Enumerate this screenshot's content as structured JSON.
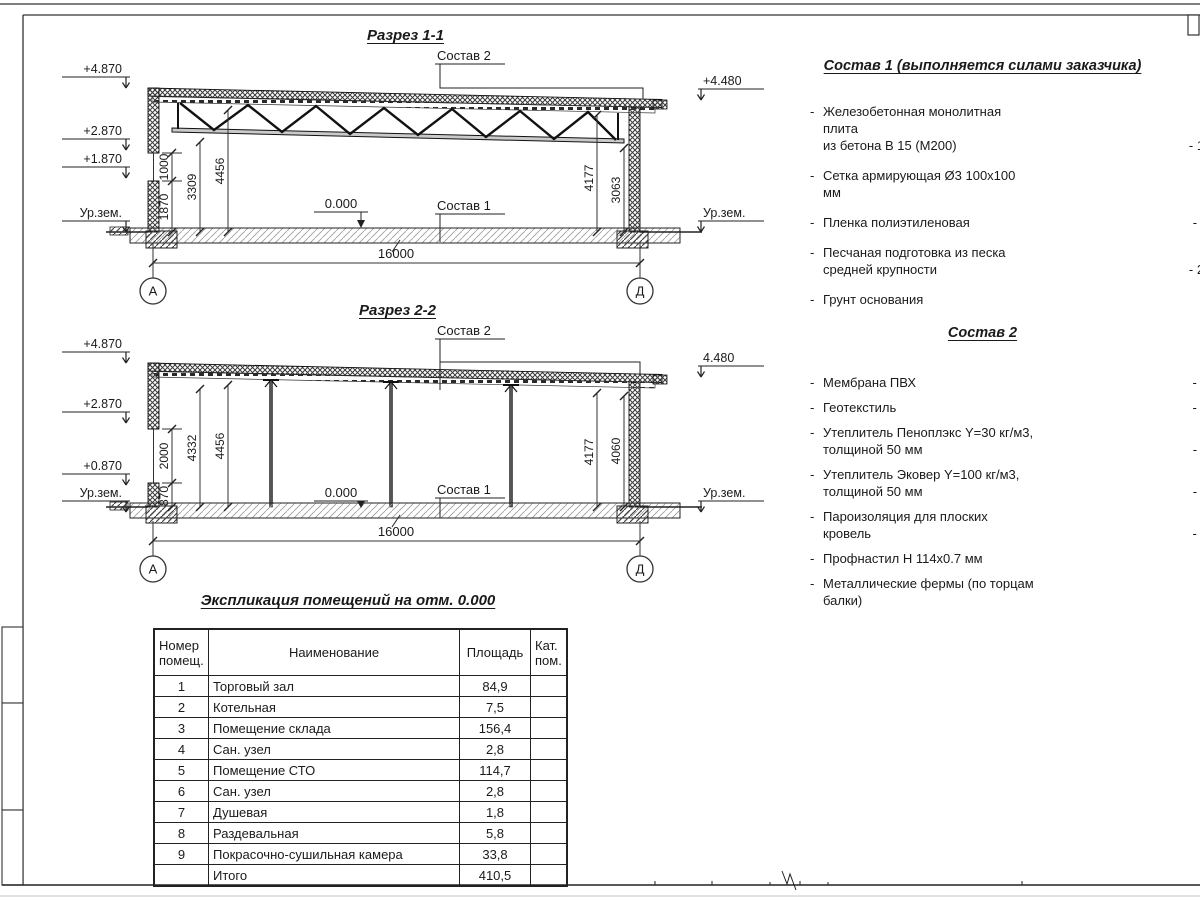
{
  "s11": {
    "title": "Разрез 1-1",
    "elev": {
      "e1": "+4.870",
      "e2": "+2.870",
      "e3": "+1.870",
      "ground_l": "Ур.зем.",
      "e_right": "+4.480",
      "ground_r": "Ур.зем."
    },
    "dims": {
      "d_a": "1000",
      "d_b": "1870",
      "d_c": "3309",
      "d_d": "4456",
      "d_e": "4177",
      "d_f": "3063",
      "span": "16000"
    },
    "marks": {
      "zero": "0.000",
      "callout_top": "Состав 2",
      "callout_floor": "Состав 1"
    },
    "axes": {
      "left": "А",
      "right": "Д"
    }
  },
  "s22": {
    "title": "Разрез 2-2",
    "elev": {
      "e1": "+4.870",
      "e2": "+2.870",
      "e3": "+0.870",
      "ground_l": "Ур.зем.",
      "e_right": "4.480",
      "ground_r": "Ур.зем."
    },
    "dims": {
      "d_a": "2000",
      "d_b": "870",
      "d_c": "4332",
      "d_d": "4456",
      "d_e": "4177",
      "d_f": "4060",
      "span": "16000"
    },
    "marks": {
      "zero": "0.000",
      "callout_top": "Состав 2",
      "callout_floor": "Состав 1"
    },
    "axes": {
      "left": "А",
      "right": "Д"
    }
  },
  "sostav1": {
    "title": "Состав 1 (выполняется силами заказчика)",
    "bullet": "-",
    "items": [
      {
        "l1": "Железобетонная  монолитная плита",
        "l2": "из бетона В 15 (М200)",
        "value": "- 150 мм"
      },
      {
        "l1": "Сетка армирующая Ø3 100х100 мм",
        "l2": "",
        "value": ""
      },
      {
        "l1": "Пленка полиэтиленовая",
        "l2": "",
        "value": "-  2 слоя"
      },
      {
        "l1": "Песчаная подготовка из песка",
        "l2": "средней крупности",
        "value": "- 200 мм"
      },
      {
        "l1": "Грунт основания",
        "l2": "",
        "value": ""
      }
    ]
  },
  "sostav2": {
    "title": "Состав 2",
    "bullet": "-",
    "items": [
      {
        "l1": "Мембрана ПВХ",
        "l2": "",
        "value": "- 1 слой"
      },
      {
        "l1": "Геотекстиль",
        "l2": "",
        "value": "- 1 слой"
      },
      {
        "l1": "Утеплитель Пеноплэкс Y=30 кг/м3,",
        "l2": "толщиной 50 мм",
        "value": "- 2 слоя"
      },
      {
        "l1": "Утеплитель Эковер Y=100 кг/м3,",
        "l2": "толщиной 50 мм",
        "value": "- 2 слоя"
      },
      {
        "l1": "Пароизоляция для плоских кровель",
        "l2": "",
        "value": "- 1 слой"
      },
      {
        "l1": "Профнастил Н 114х0.7 мм",
        "l2": "",
        "value": ""
      },
      {
        "l1": "Металлические фермы (по торцам балки)",
        "l2": "",
        "value": ""
      }
    ]
  },
  "table": {
    "title": "Экспликация помещений на отм. 0.000",
    "headers": {
      "num": "Номер помещ.",
      "name": "Наименование",
      "area": "Площадь",
      "cat": "Кат. пом."
    },
    "rows": [
      {
        "num": "1",
        "name": "Торговый зал",
        "area": "84,9",
        "cat": ""
      },
      {
        "num": "2",
        "name": "Котельная",
        "area": "7,5",
        "cat": ""
      },
      {
        "num": "3",
        "name": "Помещение склада",
        "area": "156,4",
        "cat": ""
      },
      {
        "num": "4",
        "name": "Сан. узел",
        "area": "2,8",
        "cat": ""
      },
      {
        "num": "5",
        "name": "Помещение СТО",
        "area": "114,7",
        "cat": ""
      },
      {
        "num": "6",
        "name": "Сан. узел",
        "area": "2,8",
        "cat": ""
      },
      {
        "num": "7",
        "name": "Душевая",
        "area": "1,8",
        "cat": ""
      },
      {
        "num": "8",
        "name": "Раздевальная",
        "area": "5,8",
        "cat": ""
      },
      {
        "num": "9",
        "name": "Покрасочно-сушильная камера",
        "area": "33,8",
        "cat": ""
      },
      {
        "num": "",
        "name": "Итого",
        "area": "410,5",
        "cat": ""
      }
    ]
  }
}
